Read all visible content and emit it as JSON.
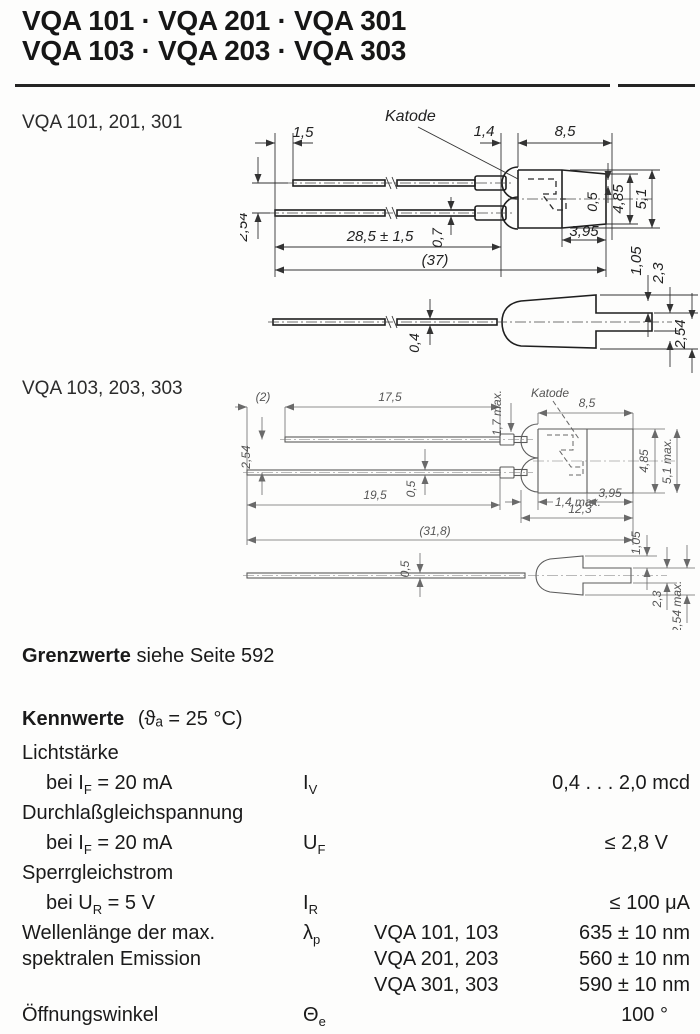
{
  "header": {
    "title_line1": "VQA 101 · VQA 201 · VQA 301",
    "title_line2": "VQA 103 · VQA 203 · VQA 303"
  },
  "drawing1": {
    "label": "VQA 101, 201, 301",
    "katode": "Katode",
    "dims": {
      "d1_5": "1,5",
      "d1_4": "1,4",
      "d8_5": "8,5",
      "d4_85": "4,85",
      "d5_1": "5,1",
      "d3_95": "3,95",
      "d0_5": "0,5",
      "d0_7": "0,7",
      "d28_5": "28,5 ± 1,5",
      "d37": "(37)",
      "d2_54": "2,54",
      "d1_05": "1,05",
      "d2_3": "2,3",
      "d0_4": "0,4",
      "d2_54b": "2,54"
    }
  },
  "drawing2": {
    "label": "VQA 103, 203, 303",
    "katode": "Katode",
    "dims": {
      "d2": "(2)",
      "d17_5": "17,5",
      "d1_7": "1,7 max.",
      "d8_5": "8,5",
      "d4_85": "4,85",
      "d5_1": "5,1 max.",
      "d2_54": "2,54",
      "d0_5": "0,5",
      "d19_5": "19,5",
      "d1_4": "1,4 max.",
      "d3_95": "3,95",
      "d12_3": "12,3",
      "d31_8": "(31,8)",
      "d0_5b": "0,5",
      "d1_05": "1,05",
      "d2_3": "2,3",
      "d2_54b": "2,54 max."
    }
  },
  "grenzwerte": {
    "bold": "Grenzwerte",
    "rest": " siehe Seite 592"
  },
  "kennwerte": {
    "title": "Kennwerte",
    "cond": "(ϑₐ = 25 °C)",
    "lichtstaerke": {
      "group": "Lichtstärke",
      "cond_pre": "bei I",
      "cond_sub": "F",
      "cond_post": " = 20 mA",
      "sym": "I",
      "sym_sub": "V",
      "value": "0,4 . . . 2,0 mcd"
    },
    "durchlass": {
      "group": "Durchlaßgleichspannung",
      "cond_pre": "bei I",
      "cond_sub": "F",
      "cond_post": " = 20 mA",
      "sym": "U",
      "sym_sub": "F",
      "value": "≤ 2,8 V"
    },
    "sperr": {
      "group": "Sperrgleichstrom",
      "cond_pre": "bei U",
      "cond_sub": "R",
      "cond_post": " = 5 V",
      "sym": "I",
      "sym_sub": "R",
      "value": "≤ 100 μA"
    },
    "wellenlaenge": {
      "l1": "Wellenlänge der max.",
      "l2": "spektralen Emission",
      "sym": "λ",
      "sym_sub": "p",
      "e1_t": "VQA 101, 103",
      "e1_v": "635 ± 10 nm",
      "e2_t": "VQA 201, 203",
      "e2_v": "560 ± 10 nm",
      "e3_t": "VQA 301, 303",
      "e3_v": "590 ± 10 nm"
    },
    "winkel": {
      "label": "Öffnungswinkel",
      "sym": "Θ",
      "sym_sub": "e",
      "value": "100 °"
    }
  }
}
